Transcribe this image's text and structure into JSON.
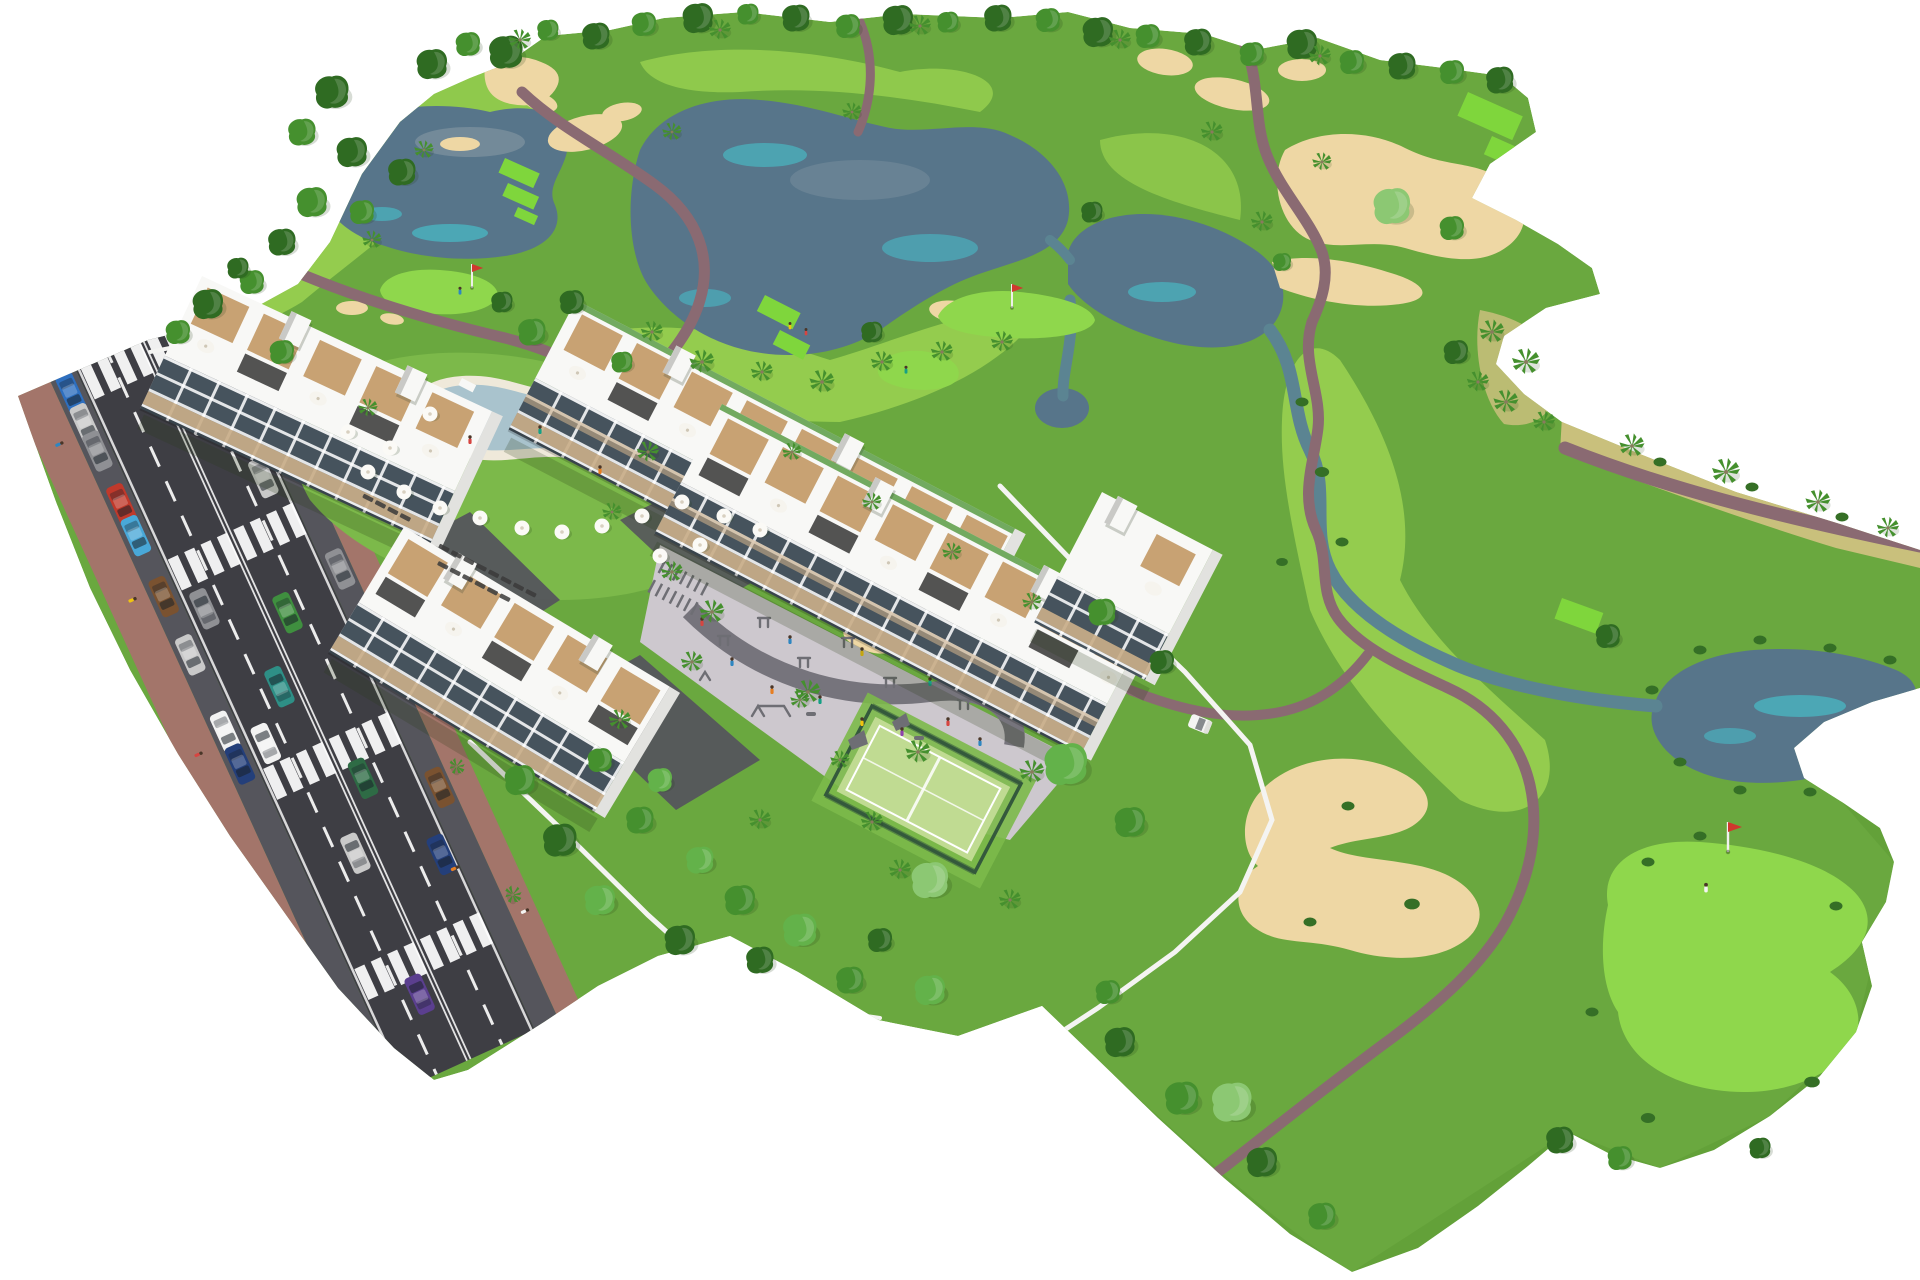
{
  "meta": {
    "description": "Aerial 3D architectural rendering of a golf resort residential development: white apartment blocks with rooftop wooden terraces, parasols and pergolas beside a diagonal road with cars, crosswalks and parking; communal lawn with free-form swimming pool, sun loungers and parasols; central playground and outdoor gym plaza; padel court; surrounding golf course with lakes, streams, sand bunkers, cart paths, tee boxes, putting greens with flags, golfers, a golf cart, round trees and palm trees on a plain white background."
  },
  "palette": {
    "bg": "#ffffff",
    "grass": "#6aa83f",
    "grassLight": "#7cb94a",
    "fairway": "#94cc4e",
    "roughDark": "#5d9b35",
    "teeGreen": "#7fd63c",
    "puttingGreen": "#8fd74c",
    "sand": "#eed7a4",
    "water": "#57758a",
    "waterTeal": "#45c8d2",
    "waterLight": "#8a9aa5",
    "stream": "#5b8492",
    "dryGrass": "#c9c07c",
    "rock": "#aab0ae",
    "cartPath": "#8a6a72",
    "road": "#3e3e44",
    "roadLane": "#55555c",
    "sidewalk": "#a3756a",
    "marking": "#ffffff",
    "wall": "#f4f4f2",
    "building": "#f8f8f6",
    "buildingShade": "#e2e2df",
    "buildingDark": "#c9c9c6",
    "glass": "#46535d",
    "balcony": "#c9ae89",
    "wood": "#c8a273",
    "pergola": "#3b3b3b",
    "poolDeck": "#efe9da",
    "poolWater": "#a9c3cd",
    "poolWaterLight": "#c9dade",
    "plaza": "#cdc8ce",
    "plazaBand": "#76747c",
    "equipment": "#6e6e74",
    "padelSurface": "#c0db92",
    "padelFence": "#34593c",
    "treeDark": "#2f6b22",
    "treeMid": "#45902e",
    "treeLight": "#63b24a",
    "treePale": "#8cc873",
    "shrub": "#356f26",
    "shadow": "rgba(40,60,25,0.22)",
    "carWhite": "#f2f2f2",
    "carSilver": "#c9c9c9",
    "carGray": "#8f9094",
    "carRed": "#c0392b",
    "carBlue": "#2e6fbf",
    "carLtBlue": "#49a8d8",
    "carGreen": "#3f8f3f",
    "carDkGreen": "#2e6b45",
    "carTeal": "#2e8f86",
    "carBrown": "#7a5230",
    "carNavy": "#243f7a",
    "carPurple": "#5b3f8f"
  },
  "scene": {
    "background": "white",
    "site_areas": [
      "golf-course",
      "apartment-buildings",
      "access-road",
      "pool-lawn",
      "playground-plaza",
      "padel-court",
      "gardens"
    ],
    "golf": {
      "lakes": 4,
      "streams": 2,
      "bunker_clusters": 8,
      "tee_boxes": 8,
      "putting_greens": 4,
      "flags": 3,
      "golfers": 3,
      "golf_carts": 1
    },
    "road": {
      "lanes": 4,
      "crosswalks": 4,
      "parking": "both-sides",
      "car_colors": [
        "white",
        "silver",
        "gray",
        "red",
        "blue",
        "light-blue",
        "green",
        "dark-green",
        "teal",
        "brown",
        "navy",
        "purple"
      ]
    },
    "buildings": {
      "blocks": 5,
      "style": "white modern apartments, glazed balconies with beige balustrades, rooftop wood-deck terraces, dark pergolas and white parasols, stair towers"
    },
    "amenities": [
      "swimming-pool",
      "sun-loungers",
      "parasols",
      "playground",
      "outdoor-gym",
      "bike-racks",
      "padel-court"
    ],
    "vegetation": [
      "round-trees",
      "palm-trees",
      "shrubs",
      "dry-grass-bank"
    ]
  }
}
